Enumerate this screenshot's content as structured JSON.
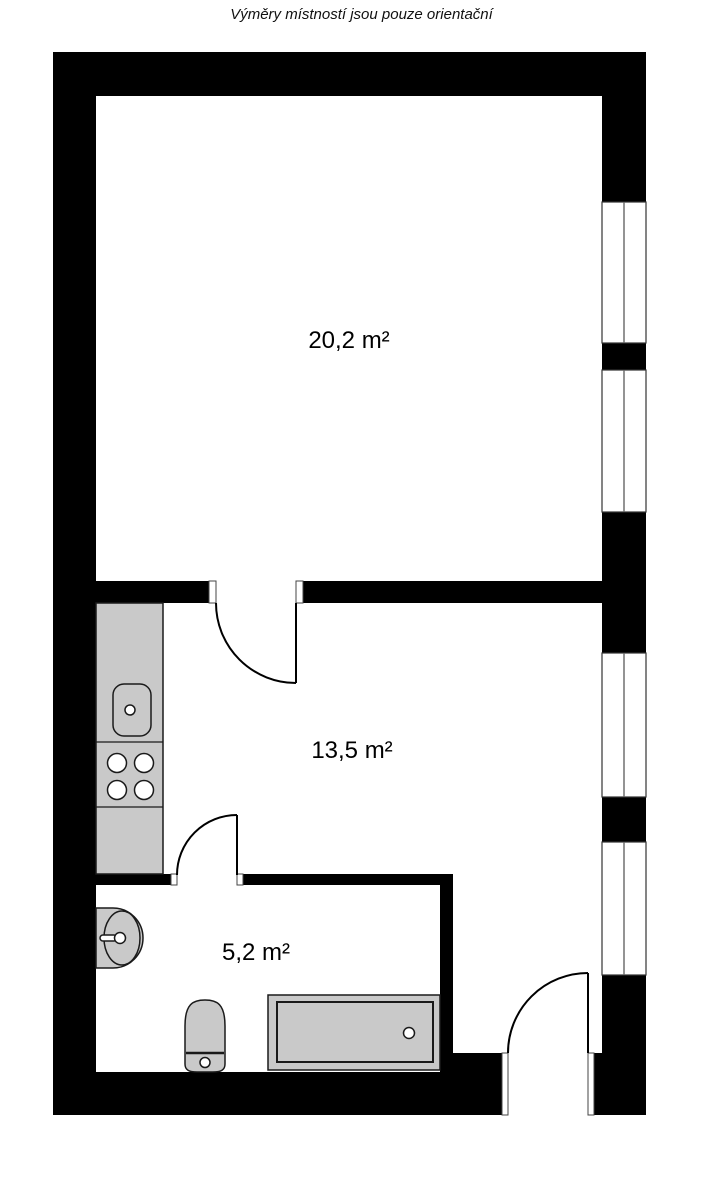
{
  "title": "Výměry místností jsou pouze orientační",
  "rooms": {
    "living": {
      "area": "20,2 m²"
    },
    "main": {
      "area": "13,5 m²"
    },
    "bathroom": {
      "area": "5,2 m²"
    }
  },
  "colors": {
    "wall": "#000000",
    "fixture": "#c9c9c9",
    "outline": "#1a1a1a",
    "window_line": "#666666",
    "background": "#ffffff"
  }
}
